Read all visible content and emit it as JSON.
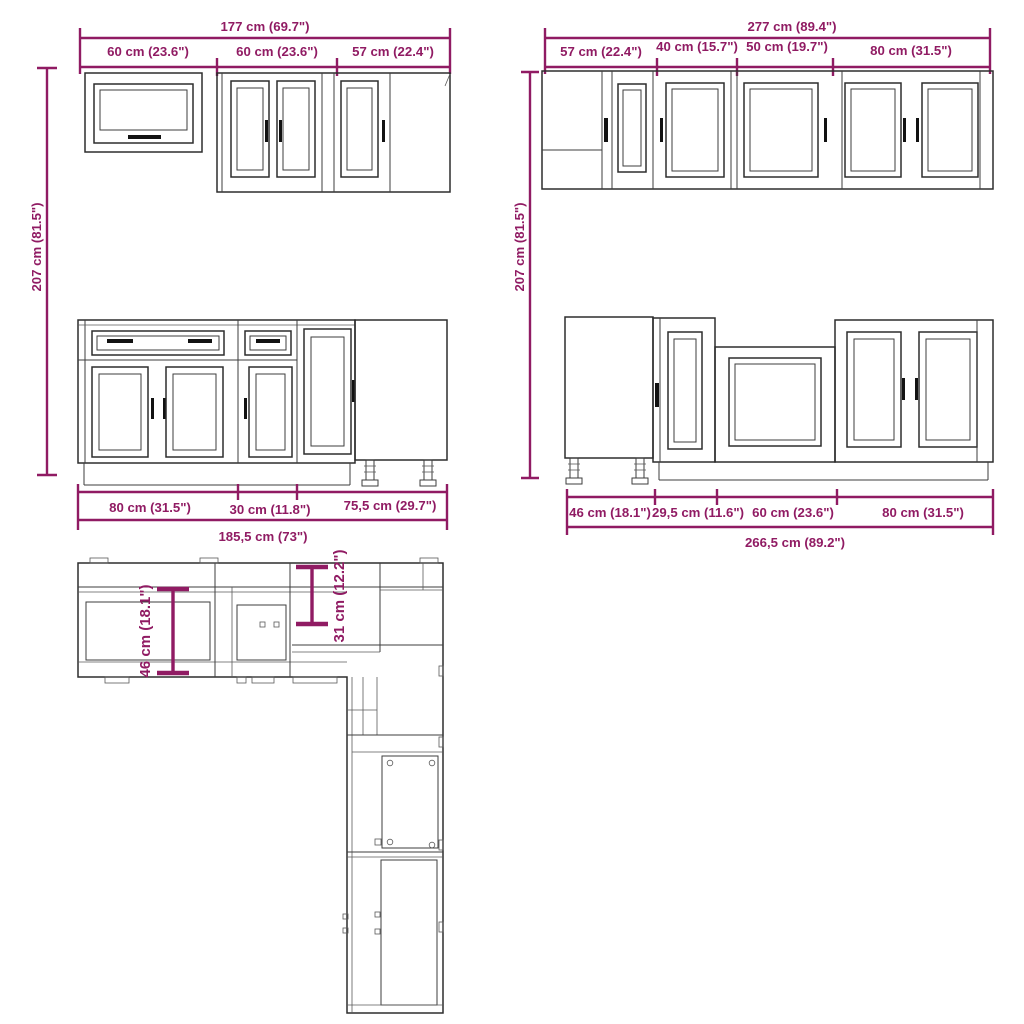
{
  "colors": {
    "dimension_accent": "#901b63",
    "drawing_line": "#2d2d2d",
    "background": "#ffffff"
  },
  "diagrams": {
    "wall_run_left": {
      "total_width": "177 cm (69.7\")",
      "segments": [
        "60 cm (23.6\")",
        "60 cm (23.6\")",
        "57 cm (22.4\")"
      ],
      "height": "207 cm (81.5\")"
    },
    "wall_run_right": {
      "total_width": "277 cm (89.4\")",
      "segments": [
        "57 cm (22.4\")",
        "40 cm (15.7\")",
        "50 cm (19.7\")",
        "80 cm (31.5\")"
      ],
      "height": "207 cm (81.5\")"
    },
    "base_run_left": {
      "segments": [
        "80 cm (31.5\")",
        "30 cm (11.8\")",
        "75,5 cm (29.7\")"
      ],
      "total_width": "185,5 cm (73\")"
    },
    "base_run_right": {
      "segments": [
        "46 cm (18.1\")",
        "29,5 cm (11.6\")",
        "60 cm (23.6\")",
        "80 cm (31.5\")"
      ],
      "total_width": "266,5 cm (89.2\")"
    },
    "floor_plan": {
      "base_depth": "46 cm (18.1\")",
      "wall_cabinet_depth": "31 cm (12.2\")"
    }
  }
}
